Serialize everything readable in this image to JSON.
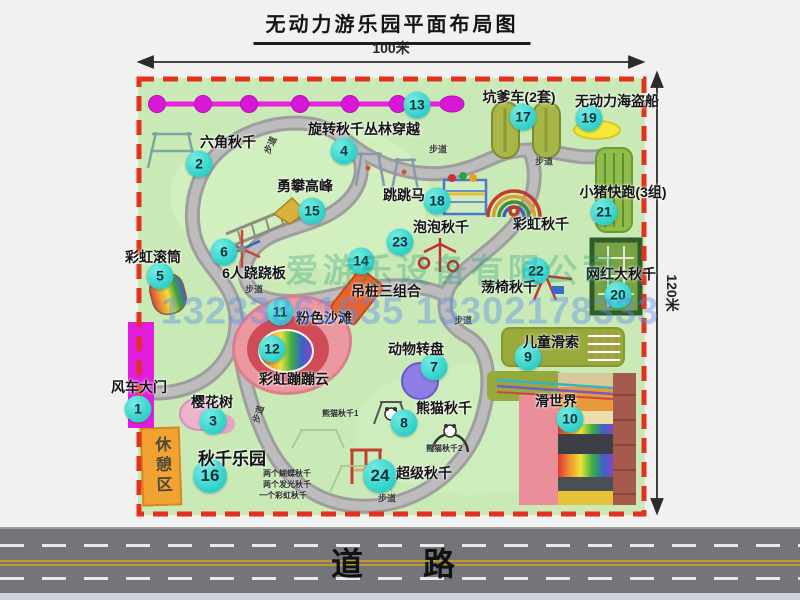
{
  "title": "无动力游乐园平面布局图",
  "dim_width": "100米",
  "dim_height": "120米",
  "road_label": "道　路",
  "watermark_company": "爱游乐设备有限公司",
  "watermark_phone": "13233861635 13302178333",
  "rest_area": "休憩区",
  "path_label": "步道",
  "rainbow_swing": "彩虹秋千",
  "swing_park_notes": [
    "两个蝴蝶秋千",
    "两个发光秋千",
    "一个彩虹秋千"
  ],
  "panda_notes": [
    "熊猫秋千1",
    "熊猫秋千2"
  ],
  "attractions": [
    {
      "num": "1",
      "label": "风车大门"
    },
    {
      "num": "2",
      "label": "六角秋千"
    },
    {
      "num": "3",
      "label": "樱花树"
    },
    {
      "num": "4",
      "label": "旋转秋千"
    },
    {
      "num": "5",
      "label": "彩虹滚筒"
    },
    {
      "num": "6",
      "label": "6人跷跷板"
    },
    {
      "num": "7",
      "label": "动物转盘"
    },
    {
      "num": "8",
      "label": "熊猫秋千"
    },
    {
      "num": "9",
      "label": "儿童滑索"
    },
    {
      "num": "10",
      "label": "滑世界"
    },
    {
      "num": "11",
      "label": "粉色沙滩"
    },
    {
      "num": "12",
      "label": "彩虹蹦蹦云"
    },
    {
      "num": "13",
      "label": "丛林穿越"
    },
    {
      "num": "14",
      "label": "吊桩三组合"
    },
    {
      "num": "15",
      "label": "勇攀高峰"
    },
    {
      "num": "16",
      "label": "秋千乐园"
    },
    {
      "num": "17",
      "label": "坑爹车(2套)"
    },
    {
      "num": "18",
      "label": "跳跳马"
    },
    {
      "num": "19",
      "label": "无动力海盗船"
    },
    {
      "num": "20",
      "label": "网红大秋千"
    },
    {
      "num": "21",
      "label": "小猪快跑(3组)"
    },
    {
      "num": "22",
      "label": "荡椅秋千"
    },
    {
      "num": "23",
      "label": "泡泡秋千"
    },
    {
      "num": "24",
      "label": "超级秋千"
    }
  ]
}
